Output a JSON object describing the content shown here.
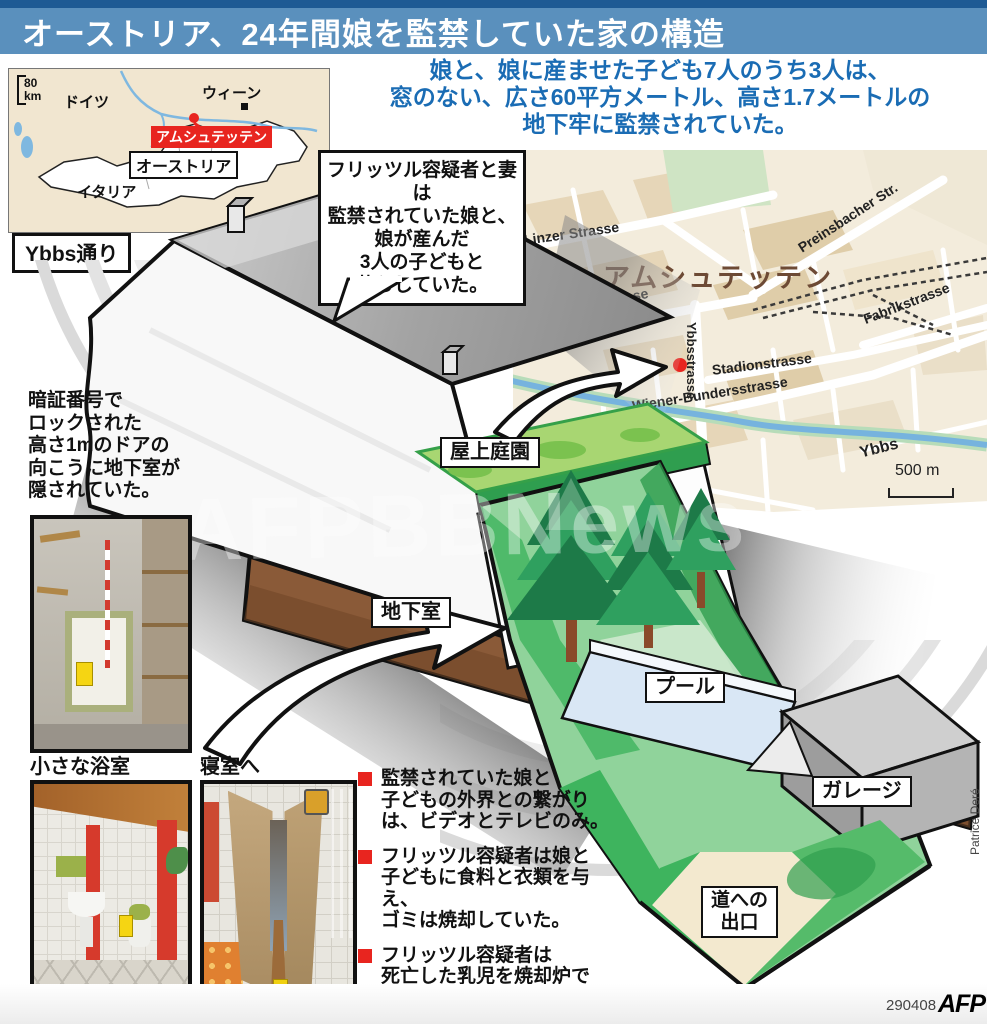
{
  "header": {
    "title": "オーストリア、24年間娘を監禁していた家の構造"
  },
  "intro": {
    "lines": [
      "娘と、娘に産ませた子ども7人のうち3人は、",
      "窓のない、広さ60平方メートル、高さ1.7メートルの",
      "地下牢に監禁されていた。"
    ]
  },
  "austria_map": {
    "scale_value": "80",
    "scale_unit": "km",
    "labels": {
      "germany": "ドイツ",
      "vienna": "ウィーン",
      "amstetten": "アムシュテッテン",
      "austria": "オーストリア",
      "italy": "イタリア"
    }
  },
  "street_sign": "Ybbs通り",
  "bubble": {
    "lines": [
      "フリッツル容疑者と妻は",
      "監禁されていた娘と、",
      "娘が産んだ",
      "3人の子どもと",
      "暮らしていた。"
    ]
  },
  "city_map": {
    "city": "アムシュテッテン",
    "streets": [
      "Linzer Strasse",
      "Preinsbacher Str.",
      "Waidhofner Strasse",
      "Fabrikstrasse",
      "Ybbsstrasse",
      "Stadionstrasse",
      "Wiener-Bundersstrasse"
    ],
    "river": "Ybbs",
    "scale": "500 m"
  },
  "house": {
    "roof_garden": "屋上庭園",
    "basement": "地下室",
    "pool": "プール",
    "garage": "ガレージ",
    "exit_line1": "道への",
    "exit_line2": "出口"
  },
  "basement_note": {
    "lines": [
      "暗証番号で",
      "ロックされた",
      "高さ1mのドアの",
      "向こうに地下室が",
      "隠されていた。"
    ]
  },
  "photos": {
    "bathroom_caption": "小さな浴室",
    "bedroom_caption": "寝室へ"
  },
  "facts": [
    {
      "lines": [
        "監禁されていた娘と",
        "子どもの外界との繋がり",
        "は、ビデオとテレビのみ。"
      ]
    },
    {
      "lines": [
        "フリッツル容疑者は娘と",
        "子どもに食料と衣類を与え、",
        "ゴミは焼却していた。"
      ]
    },
    {
      "lines": [
        "フリッツル容疑者は",
        "死亡した乳児を焼却炉で",
        "処分した。"
      ]
    }
  ],
  "credit": "Patrice Deré",
  "footer": {
    "date": "290408",
    "agency": "AFP"
  },
  "watermark": "AFPBBNews",
  "colors": {
    "header_blue": "#5a90bd",
    "header_dark_blue": "#1d5a94",
    "intro_blue": "#1a6cb4",
    "accent_red": "#e8251f",
    "basement_brown": "#8a5a38",
    "lawn_green": "#3eb45e",
    "map_beige": "#f3ecdc",
    "roof_gray": "#9c9c9c"
  }
}
